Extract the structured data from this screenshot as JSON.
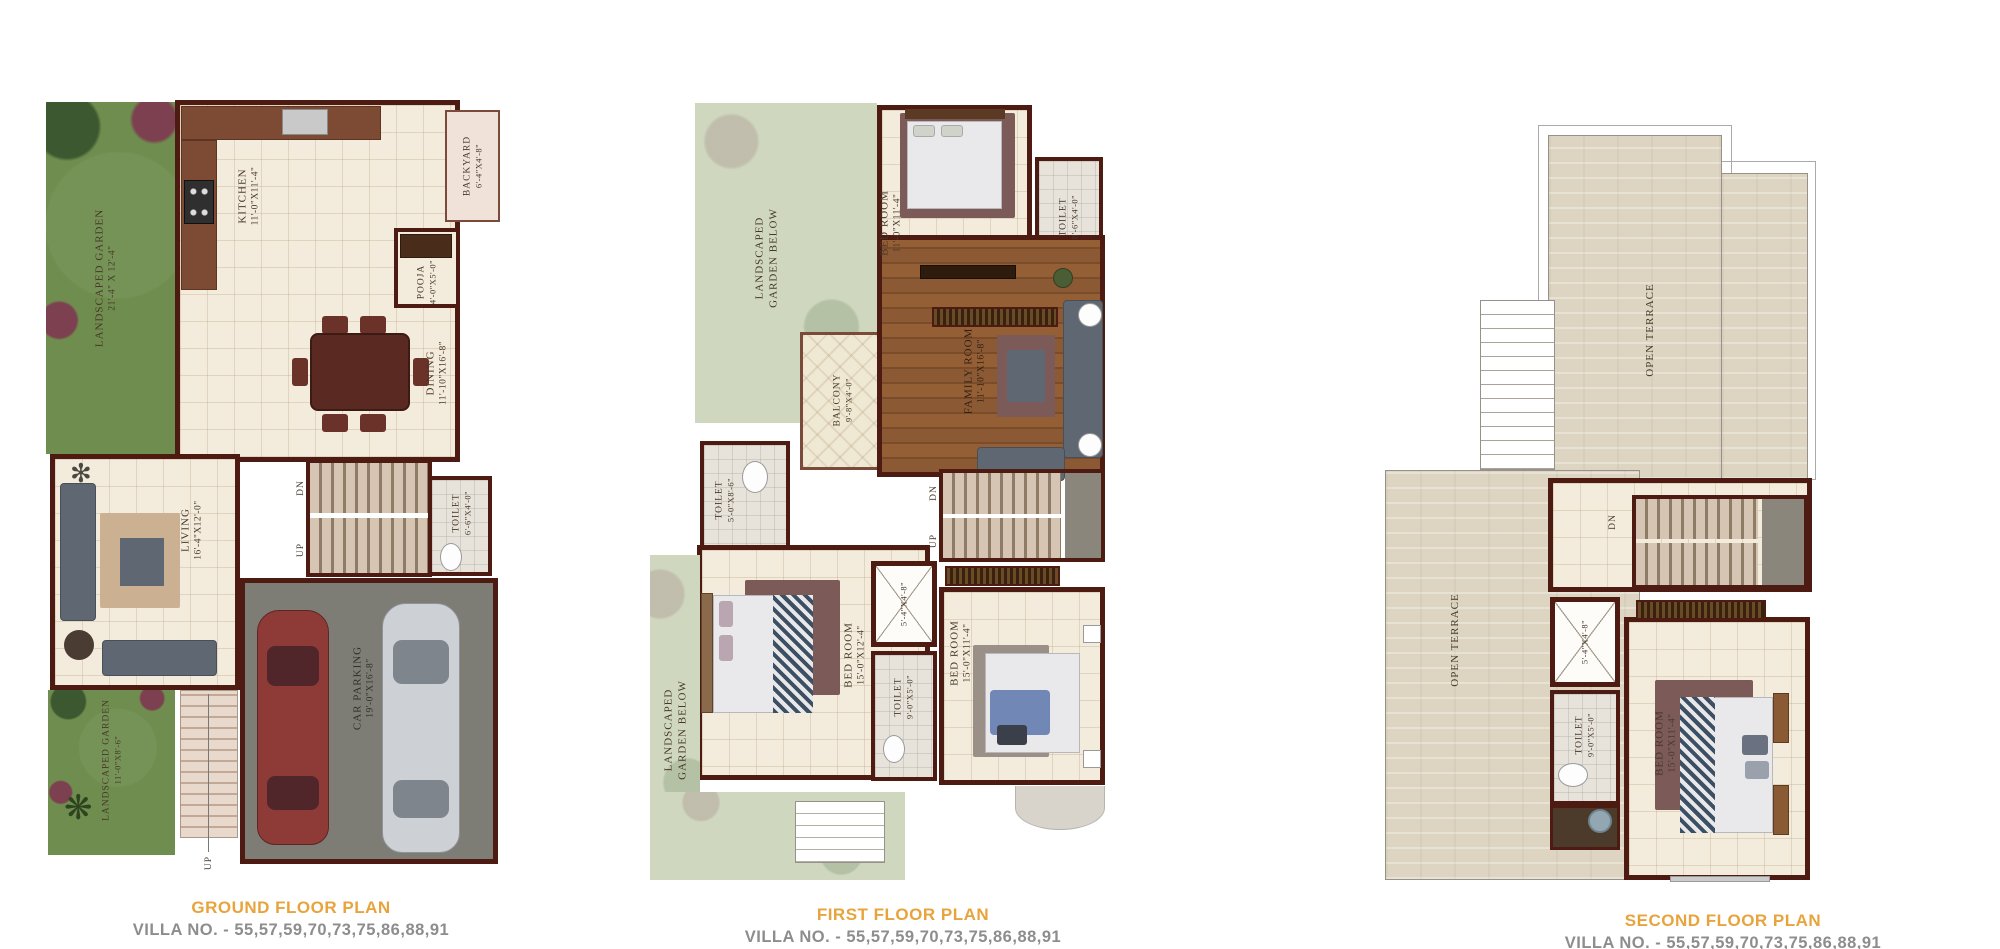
{
  "colors": {
    "wall": "#4e1b12",
    "title_accent": "#e8a43c",
    "subtitle_gray": "#8d8d8d",
    "garden": "#6f8d4e",
    "carpark": "#7e7d75"
  },
  "plans": [
    {
      "title": "GROUND FLOOR PLAN",
      "villa_no": "VILLA NO. - 55,57,59,70,73,75,86,88,91",
      "rooms": {
        "garden_tl": {
          "name": "LANDSCAPED GARDEN",
          "dims": "21'-4\" X 12'-4\""
        },
        "kitchen": {
          "name": "KITCHEN",
          "dims": "11'-0\"X11'-4\""
        },
        "backyard": {
          "name": "BACKYARD",
          "dims": "6'-4\"X4'-8\""
        },
        "pooja": {
          "name": "POOJA",
          "dims": "4'-0\"X5'-0\""
        },
        "dining": {
          "name": "DINING",
          "dims": "11'-10\"X16'-8\""
        },
        "living": {
          "name": "LIVING",
          "dims": "16'-4\"X12'-0\""
        },
        "toilet": {
          "name": "TOILET",
          "dims": "6'-6\"X4'-0\""
        },
        "car_parking": {
          "name": "CAR PARKING",
          "dims": "19'-0\"X16'-8\""
        },
        "garden_bl": {
          "name": "LANDSCAPED GARDEN",
          "dims": "11'-0\"X8'-6\""
        }
      },
      "stairs": {
        "dn": "DN",
        "up": "UP"
      },
      "entry_up": "UP"
    },
    {
      "title": "FIRST FLOOR PLAN",
      "villa_no": "VILLA NO. - 55,57,59,70,73,75,86,88,91",
      "rooms": {
        "garden_tl": {
          "name": "LANDSCAPED",
          "dims": "GARDEN BELOW"
        },
        "bedroom_top": {
          "name": "BED ROOM",
          "dims": "11'-0\"X11'-4\""
        },
        "toilet_tr": {
          "name": "TOILET",
          "dims": "8'-6\"X4'-0\""
        },
        "balcony": {
          "name": "BALCONY",
          "dims": "9'-8\"X4'-0\""
        },
        "family": {
          "name": "FAMILY ROOM",
          "dims": "11'-10\"X16'-8\""
        },
        "toilet_ml": {
          "name": "TOILET",
          "dims": "5'-0\"X8'-6\""
        },
        "bedroom_bl": {
          "name": "BED ROOM",
          "dims": "15'-0\"X12'-4\""
        },
        "shaft": {
          "dims": "5'-4\"X4'-8\""
        },
        "toilet_br": {
          "name": "TOILET",
          "dims": "9'-0\"X5'-0\""
        },
        "bedroom_br": {
          "name": "BED ROOM",
          "dims": "15'-0\"X11'-4\""
        },
        "garden_bl": {
          "name": "LANDSCAPED",
          "dims": "GARDEN BELOW"
        }
      },
      "stairs": {
        "dn": "DN",
        "up": "UP"
      }
    },
    {
      "title": "SECOND FLOOR PLAN",
      "villa_no": "VILLA NO. - 55,57,59,70,73,75,86,88,91",
      "rooms": {
        "terrace_top": {
          "name": "OPEN TERRACE"
        },
        "terrace_left": {
          "name": "OPEN TERRACE"
        },
        "shaft": {
          "dims": "5'-4\"X4'-8\""
        },
        "toilet": {
          "name": "TOILET",
          "dims": "9'-0\"X5'-0\""
        },
        "bedroom": {
          "name": "BED ROOM",
          "dims": "15'-0\"X11'-4\""
        }
      },
      "stairs": {
        "dn": "DN"
      }
    }
  ]
}
